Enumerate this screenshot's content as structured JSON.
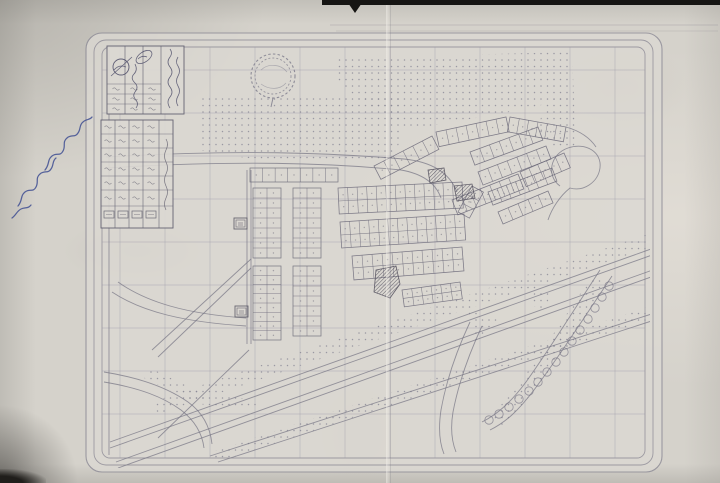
{
  "document": {
    "kind": "photograph of a folded photocopied town-planning / cadastral map",
    "script_language": "Arabic",
    "legible_text": false,
    "handwritten_annotation": {
      "present": true,
      "ink": "blue",
      "legible": false,
      "position": "left margin, written diagonally"
    }
  },
  "page": {
    "background": "#d5d2cb",
    "map_paper": "#dcd9d3",
    "ink": "#767484",
    "plot_ink": "#6b6979",
    "grid_ink": "#9b99a8",
    "dark_ink": "#55525f",
    "hand_ink": "#3e4d92",
    "edge_color": "#161513"
  },
  "title_block": {
    "columns": 4,
    "data_rows": 3,
    "text_legible": false,
    "stamp": "circle with diagonal slash",
    "seal": "small rotated oval with signature"
  },
  "legend_table": {
    "columns": 5,
    "rows": 7,
    "has_symbol_row": true,
    "text_legible": false
  },
  "map_render": {
    "borders": [
      {
        "x": 86,
        "y": 33,
        "w": 576,
        "h": 439,
        "r": 16
      },
      {
        "x": 94,
        "y": 40,
        "w": 559,
        "h": 425,
        "r": 12
      },
      {
        "x": 102,
        "y": 47,
        "w": 543,
        "h": 411,
        "r": 8
      }
    ],
    "grid": {
      "vxs": [
        120,
        165,
        210,
        255,
        300,
        345,
        390,
        435,
        480,
        525,
        570,
        615
      ],
      "hys": [
        70,
        113,
        156,
        199,
        242,
        285,
        328,
        371,
        414
      ],
      "x0": 102,
      "x1": 645,
      "y0": 47,
      "y1": 458
    },
    "stipples": [
      "198,98 404,96 402,134 394,158 336,161 246,158 198,150",
      "334,58 572,52 574,98 500,114 440,124 406,131 394,120 360,100 334,78",
      "546,100 574,96 576,148 552,150 538,128",
      "152,402 648,234 654,246 158,414",
      "212,452 662,302 668,314 218,462",
      "604,282 592,276 556,330 522,380 490,418 502,428 540,384 578,330",
      "150,368 204,394 258,400 256,410 198,404 144,378",
      "468,310 498,320 476,344",
      "534,286 552,292 544,310 528,304"
    ],
    "roads": [
      "M106,157 C240,149 330,153 404,159",
      "M106,168 C240,160 330,163 401,170",
      "M404,159 C434,162 450,174 457,192",
      "M401,170 C424,174 436,184 441,198",
      "M247,170 L247,344",
      "M251,170 L251,344",
      "M109,50 L109,455",
      "M152,350 L251,259",
      "M158,357 L251,268",
      "M158,438 L249,350",
      "M110,442 L651,249",
      "M110,448 L655,254",
      "M116,462 L661,267",
      "M118,468 L665,272",
      "M210,456 L664,310",
      "M218,462 L667,316",
      "M612,276 C584,318 558,358 534,390 C518,411 506,422 490,430",
      "M600,270 C574,310 549,350 526,382 C511,402 498,414 482,422",
      "M470,322 C456,352 446,382 441,410 C438,430 440,444 444,454",
      "M482,326 C468,356 458,386 453,412 C450,430 452,442 456,452",
      "M118,282 C146,302 186,314 246,318",
      "M112,292 C142,312 184,322 246,326",
      "M104,372 C142,378 168,388 188,402 C202,412 210,426 212,444",
      "M104,382 C140,388 163,397 181,410 C194,420 202,432 204,448",
      "M566,127 C580,131 590,138 596,147"
    ],
    "loop": "M560,186 C546,176 550,154 568,148 C586,142 602,152 600,168 C598,182 584,192 570,188 C560,196 552,208 548,220",
    "strips": [
      {
        "x1": 250,
        "y1": 182,
        "x2": 338,
        "y2": 182,
        "d": -14,
        "n": 7
      },
      {
        "x1": 253,
        "y1": 188,
        "x2": 253,
        "y2": 258,
        "d": -28,
        "n": 7,
        "double": true
      },
      {
        "x1": 293,
        "y1": 188,
        "x2": 293,
        "y2": 258,
        "d": -28,
        "n": 7,
        "double": true
      },
      {
        "x1": 253,
        "y1": 266,
        "x2": 253,
        "y2": 340,
        "d": -28,
        "n": 8,
        "double": true
      },
      {
        "x1": 293,
        "y1": 266,
        "x2": 293,
        "y2": 336,
        "d": -28,
        "n": 7,
        "double": true
      },
      {
        "x1": 338,
        "y1": 188,
        "x2": 462,
        "y2": 182,
        "d": 26,
        "n": 13,
        "double": true
      },
      {
        "x1": 340,
        "y1": 222,
        "x2": 464,
        "y2": 214,
        "d": 26,
        "n": 13,
        "double": true
      },
      {
        "x1": 352,
        "y1": 256,
        "x2": 462,
        "y2": 247,
        "d": 24,
        "n": 11,
        "double": true
      },
      {
        "x1": 402,
        "y1": 290,
        "x2": 460,
        "y2": 282,
        "d": 17,
        "n": 6,
        "double": true
      },
      {
        "x1": 374,
        "y1": 166,
        "x2": 432,
        "y2": 136,
        "d": 15,
        "n": 6
      },
      {
        "x1": 436,
        "y1": 132,
        "x2": 506,
        "y2": 117,
        "d": 15,
        "n": 7
      },
      {
        "x1": 510,
        "y1": 117,
        "x2": 566,
        "y2": 127,
        "d": 15,
        "n": 6
      },
      {
        "x1": 452,
        "y1": 200,
        "x2": 518,
        "y2": 174,
        "d": 16,
        "n": 7
      },
      {
        "x1": 520,
        "y1": 172,
        "x2": 564,
        "y2": 153,
        "d": 16,
        "n": 5
      },
      {
        "x1": 470,
        "y1": 152,
        "x2": 538,
        "y2": 127,
        "d": 14,
        "n": 7
      },
      {
        "x1": 478,
        "y1": 172,
        "x2": 546,
        "y2": 146,
        "d": 14,
        "n": 7
      },
      {
        "x1": 488,
        "y1": 192,
        "x2": 552,
        "y2": 168,
        "d": 14,
        "n": 7
      },
      {
        "x1": 498,
        "y1": 212,
        "x2": 548,
        "y2": 191,
        "d": 13,
        "n": 5
      },
      {
        "x1": 458,
        "y1": 212,
        "x2": 472,
        "y2": 186,
        "d": 13,
        "n": 3
      }
    ],
    "trees": {
      "r": 4.2,
      "centers": [
        [
          609,
          286
        ],
        [
          602,
          297
        ],
        [
          595,
          308
        ],
        [
          588,
          319
        ],
        [
          580,
          330
        ],
        [
          572,
          341
        ],
        [
          564,
          352
        ],
        [
          556,
          362
        ],
        [
          547,
          372
        ],
        [
          538,
          382
        ],
        [
          529,
          391
        ],
        [
          519,
          399
        ],
        [
          509,
          407
        ],
        [
          499,
          414
        ],
        [
          489,
          420
        ]
      ]
    },
    "buildings": [
      "376,270 396,266 400,284 390,298 374,292",
      "428,170 444,168 446,180 430,183",
      "454,186 472,184 475,198 457,201"
    ],
    "markers": [
      {
        "x": 234,
        "y": 218
      },
      {
        "x": 235,
        "y": 306
      }
    ],
    "emblem": {
      "cx": 273,
      "cy": 76,
      "r": 22,
      "r2": 18,
      "inner": [
        "M261,70 C268,63 281,64 287,72",
        "M261,84 C269,90 280,90 286,83"
      ],
      "stem": "M273,98 L271,107"
    },
    "title_panel": {
      "x": 107,
      "y": 46,
      "w": 77,
      "h": 68,
      "vlines": [
        125,
        143,
        161
      ],
      "hrows": {
        "x1": 107,
        "x2": 161,
        "ys": [
          84,
          94,
          104
        ]
      },
      "stamp": {
        "cx": 121,
        "cy": 67,
        "r": 8
      },
      "oval": {
        "cx": 144,
        "cy": 57,
        "rx": 9,
        "ry": 5,
        "rot": -35
      },
      "marks": {
        "cols": [
          116,
          134,
          152
        ],
        "rows": [
          89,
          99,
          109
        ]
      },
      "squiggles": [
        "M135,64 q3,6 -1,10 q-4,4 1,9 q4,4 0,9 q-3,4 1,8 q3,4 0,8",
        "M170,108 q-4,-6 0,-11 q4,-5 0,-10 q-4,-5 0,-10 q4,-5 0,-10 q-4,-5 0,-10 q3,-4 0,-8",
        "M178,106 q-3,-5 0,-10 q3,-5 0,-10 q-3,-5 0,-10 q3,-5 0,-10 q-3,-4 0,-9",
        "M138,59 q4,-4 9,-2",
        "M114,70 q5,-6 12,-3",
        "M111,76 L132,57"
      ]
    },
    "legend_panel": {
      "x": 101,
      "y": 120,
      "w": 72,
      "h": 108,
      "vlines": [
        115,
        129,
        143,
        159
      ],
      "hrows": {
        "x1": 101,
        "x2": 173,
        "ys": [
          134,
          148,
          162,
          176,
          190,
          206
        ]
      },
      "symbol_row": {
        "xs": [
          104,
          118,
          132,
          146
        ],
        "y": 211,
        "w": 10,
        "h": 7
      },
      "marks": {
        "cols": [
          108,
          122,
          136,
          151
        ],
        "rows": [
          127,
          141,
          155,
          169,
          183,
          198
        ]
      },
      "header_squiggle": "M166,210 q-3,-6 0,-12 q3,-6 0,-12 q-3,-6 0,-12 q3,-6 0,-12 q-3,-6 0,-12 q3,-6 0,-11"
    },
    "handwriting": [
      "M45,170 c5,-6 2,-10 7,-14 c5,-4 8,1 11,-5 c3,-5 -1,-9 4,-13 c4,-4 8,0 11,-5 c3,-4 1,-8 5,-11 c3,-3 7,-2 9,-5",
      "M18,206 c5,-6 2,-10 7,-14 c5,-4 8,1 11,-5 c3,-5 -1,-9 4,-13 c4,-4 8,0 11,-5 c3,-4 1,-8 5,-11",
      "M12,218 c4,-3 5,-7 9,-9 c4,-2 7,0 10,-4"
    ],
    "extra_lines": [
      "M330,25 L718,25",
      "M336,31 L718,31"
    ]
  }
}
